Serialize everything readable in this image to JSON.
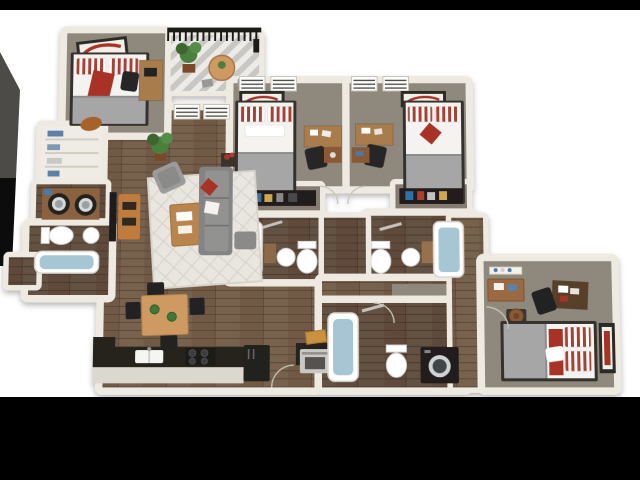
{
  "scene": {
    "title": "3D cutaway floor plan rendering of a four-bedroom, four-bathroom apartment",
    "render_style": "top-down 3D dollhouse view, white walls, letterboxed on black",
    "background": {
      "canvas": "#ffffff",
      "top_bar": "#000000",
      "bottom_bar": "#000000"
    }
  },
  "palette": {
    "wall": "#eeeae2",
    "wallEdge": "#d7d2c7",
    "carpet": "#8f887c",
    "closetFloor": "#847c70",
    "wood": "#6f5a45",
    "woodDark": "#5e4a3a",
    "rug": "#e9e6df",
    "sofa": "#848484",
    "accent": "#a83228",
    "stripeRed": "#b03a2e",
    "bedFrame": "#35312d",
    "sheet": "#f4f3f0",
    "blanket": "#a6a6a6",
    "deskWood": "#a97b4b",
    "tableWood": "#cf9a62",
    "tvStand": "#c07c3e",
    "counter": "#26231f",
    "appliance": "#c9c8c5",
    "applianceDark": "#201f1c",
    "water": "#a5c6d2",
    "plant": "#4c7f3d",
    "plantDark": "#3c662f",
    "railing": "#1c1b19",
    "shelfBlack": "#211f1d",
    "wedgeGray": "#4c4b48",
    "wedgeBlack": "#0c0c0c"
  },
  "rooms": [
    {
      "id": "bedroom-1",
      "label": "Bedroom 1 (top left)",
      "furniture": [
        "twin bed with red/white striped pillows and red throw",
        "tilted framed red wall art",
        "desk with laptop",
        "black desk chair",
        "duffel bag at foot of bed"
      ]
    },
    {
      "id": "balcony",
      "label": "Balcony / patio",
      "furniture": [
        "black railing",
        "potted plant",
        "round bistro table with cactus",
        "two stools",
        "striped decking"
      ]
    },
    {
      "id": "bedroom-2",
      "label": "Bedroom 2 (top center)",
      "furniture": [
        "two blinded windows",
        "framed red wall art",
        "twin bed with striped pillows and gray blanket",
        "desk with papers",
        "desk chair",
        "nightstand with lamp"
      ]
    },
    {
      "id": "bedroom-3",
      "label": "Bedroom 3 (top right)",
      "furniture": [
        "two blinded windows",
        "framed red wall art",
        "twin bed with striped pillows, red accent pillow and gray blanket",
        "desk with papers",
        "desk chair",
        "nightstand with blue accessory"
      ]
    },
    {
      "id": "closet-bedroom-2",
      "label": "Bedroom 2 closet",
      "furniture": [
        "black shelf with folded clothes and accessories"
      ]
    },
    {
      "id": "closet-bedroom-3",
      "label": "Bedroom 3 closet",
      "furniture": [
        "black shelf with folded clothes and accessories"
      ]
    },
    {
      "id": "bathroom-2",
      "label": "Bathroom (center left)",
      "furniture": [
        "bathtub with water",
        "pedestal sink",
        "toilet",
        "towel bar",
        "wood vanity corner"
      ]
    },
    {
      "id": "bathroom-3",
      "label": "Bathroom (center right)",
      "furniture": [
        "toilet",
        "pedestal sink",
        "wood vanity corner",
        "bathtub with water",
        "towel bar"
      ]
    },
    {
      "id": "linen-closet",
      "label": "Linen closet",
      "furniture": [
        "white shelving with blue towels"
      ]
    },
    {
      "id": "laundry-closet",
      "label": "Laundry closet",
      "furniture": [
        "front-load washer",
        "front-load dryer",
        "wood counter",
        "detergent box"
      ]
    },
    {
      "id": "bathroom-1",
      "label": "Bathroom (left wing)",
      "furniture": [
        "toilet",
        "round sink",
        "bathtub with water in bump-out"
      ]
    },
    {
      "id": "living-dining-kitchen",
      "label": "Open living / dining / kitchen",
      "furniture": [
        "two blinded windows",
        "wall TV with wood media stand",
        "gray armchair",
        "potted plant",
        "patterned area rug",
        "wood coffee table with books",
        "gray sofa with red and white pillows",
        "ottoman",
        "side table with red flowers",
        "wood dining table with two green plates and four black chairs",
        "black kitchen counter run",
        "double sink",
        "black cooktop with burners",
        "refrigerator",
        "stainless oven",
        "cutting board"
      ]
    },
    {
      "id": "hallway",
      "label": "Hallways",
      "furniture": [
        "wood corridor between bathrooms",
        "carpeted corridor to right wing",
        "interior door swings"
      ]
    },
    {
      "id": "bathroom-4",
      "label": "Bathroom (bottom, right wing)",
      "furniture": [
        "bathtub with water",
        "toilet",
        "black front-load washer/dryer",
        "towel bar"
      ]
    },
    {
      "id": "bedroom-4",
      "label": "Bedroom 4 (right wing)",
      "furniture": [
        "wall shelf with bottles",
        "wood dresser with accessories",
        "dark desk with red and white papers",
        "desk chair",
        "hat on small stand",
        "full bed with gray blanket, red blanket and striped pillows",
        "tall framed red wall art"
      ]
    }
  ]
}
